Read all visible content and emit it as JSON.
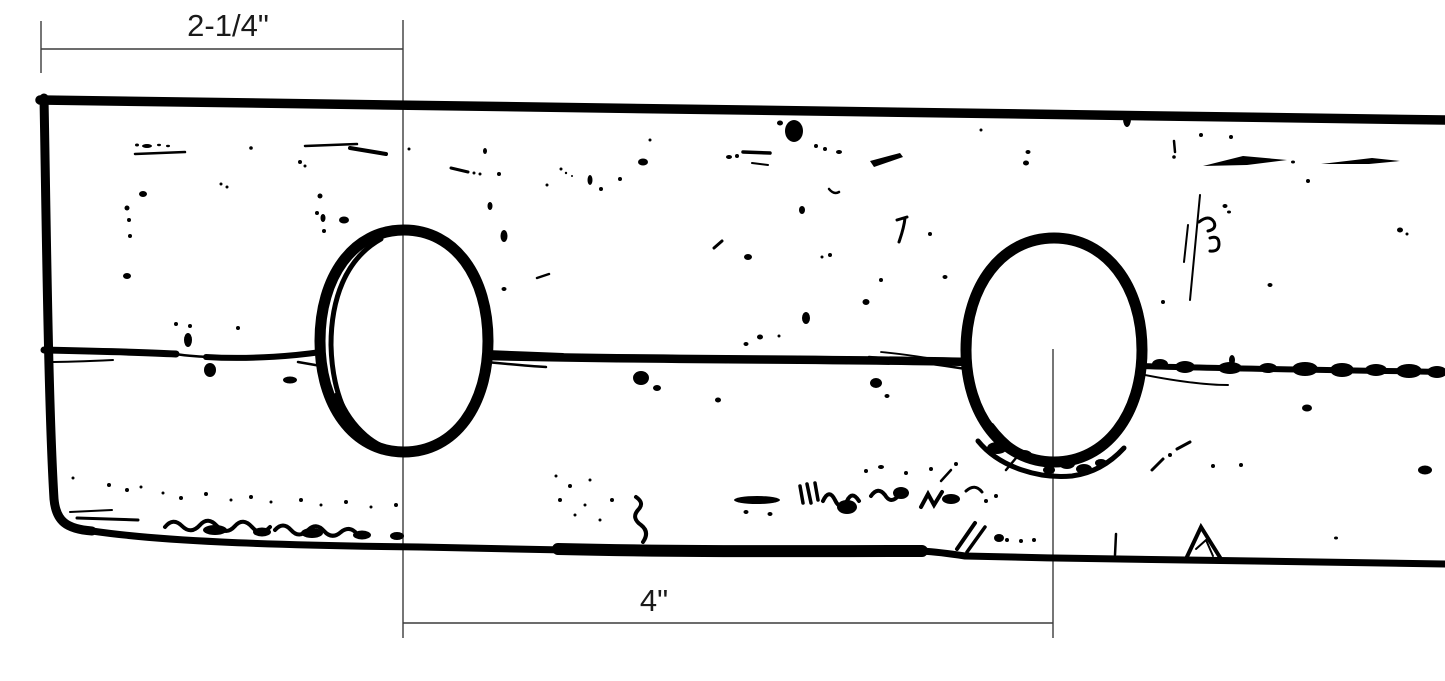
{
  "page": {
    "background_color": "#ffffff"
  },
  "drawing": {
    "type": "dimensioned-sketch",
    "subject": "long board strip with center seam and two oval holes",
    "ink_color": "#000000",
    "dimension_line_color": "#3c3c3c",
    "label_color": "#1a1a1a",
    "holes_count": 2,
    "dimensions": {
      "top": {
        "label": "2-1/4\"",
        "spans": "left end of board to center of first hole"
      },
      "bottom": {
        "label": "4\"",
        "spans": "center of first hole to center of second hole"
      }
    }
  }
}
